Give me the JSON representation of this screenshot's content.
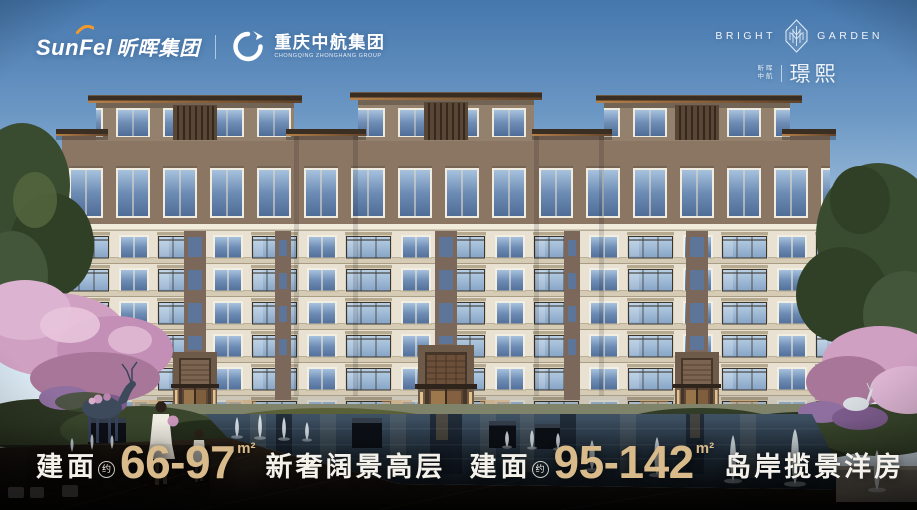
{
  "header": {
    "left": {
      "sunfel_en": "SunFel",
      "sunfel_cn": "昕晖集团",
      "caic_cn": "重庆中航集团",
      "caic_en": "CHONGQING ZHONGHANG GROUP"
    },
    "right": {
      "brand_left": "BRIGHT",
      "brand_right": "GARDEN",
      "subbrand_line1": "昕晖",
      "subbrand_line2": "中航",
      "project_name": "璟熙"
    }
  },
  "taglines": [
    {
      "prefix": "建面",
      "approx": "约",
      "range": "66-97",
      "unit": "m²",
      "desc": "新奢阔景高层"
    },
    {
      "prefix": "建面",
      "approx": "约",
      "range": "95-142",
      "unit": "m²",
      "desc": "岛岸揽景洋房"
    }
  ],
  "colors": {
    "accent_gold": "#d9bb8b",
    "text_white": "#f3f1ea",
    "swoosh_orange": "#f09a2e",
    "sky_top": "#4577ad",
    "roof_brown": "#3a2d22",
    "facade_cream": "#e9e2d2"
  }
}
